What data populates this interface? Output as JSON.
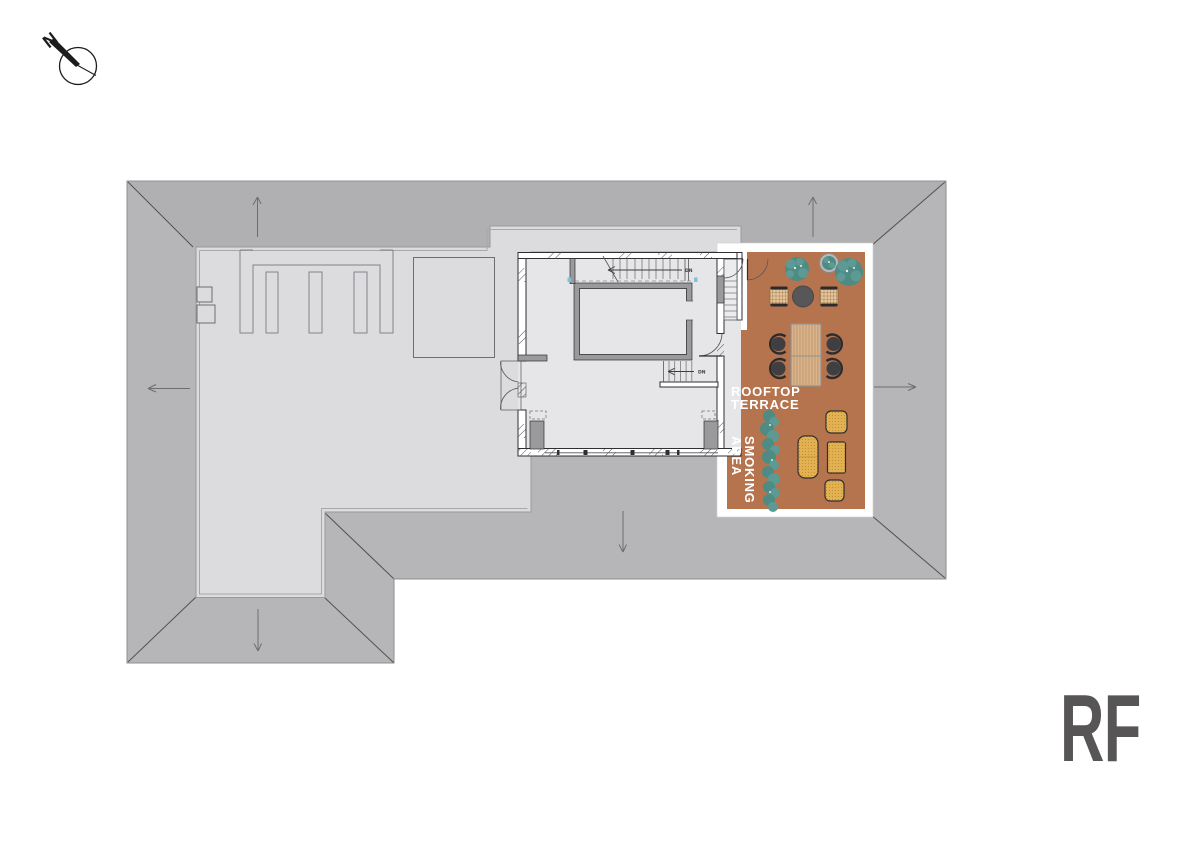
{
  "document": {
    "type": "architectural rooftop floor plan",
    "background": "#ffffff"
  },
  "labels": {
    "floor_code": "RF",
    "terrace_line1": "ROOFTOP",
    "terrace_line2": "TERRACE",
    "smoking_line1": "SMOKING",
    "smoking_line2": "AREA",
    "north": "N",
    "dn_upper": "DN",
    "dn_lower": "DN"
  },
  "areas": [
    "ROOFTOP TERRACE",
    "SMOKING AREA"
  ],
  "symbols": [
    "north-arrow-icon",
    "roof-slope-arrow",
    "stair-run",
    "door-swing",
    "roof-hatch-skylight",
    "rooftop-equipment-louvers",
    "roof-vent-boxes"
  ],
  "terrace_furniture": [
    "shrub-planter",
    "potted-plant",
    "shrub-planter",
    "round-bistro-table",
    "rattan-armchair",
    "rattan-armchair",
    "wood-dining-table",
    "dining-chair",
    "dining-chair",
    "dining-chair",
    "dining-chair",
    "hedge-screen",
    "outdoor-sofa",
    "lounge-chair",
    "outdoor-coffee-table",
    "lounge-chair"
  ],
  "colors": {
    "roof-slope": "#b6b6b8",
    "roof-top-plane": "#b0b0b2",
    "roof-flat": "#dcdcde",
    "building": "#e6e6e8",
    "wall-line": "#2f2f31",
    "outline": "#8f8f91",
    "terrace": "#b5744d",
    "terrace-frame": "#ffffff",
    "plant": "#4e8b85",
    "plant-light": "#5d9a93",
    "wood": "#d9b38c",
    "wood-line": "#b28a5f",
    "chair-dark": "#3f3f41",
    "rattan": "#e4c79e",
    "lounge": "#e3b052",
    "lounge-dot": "#a97f1f",
    "label": "#ffffff",
    "floor-code": "#575556",
    "compass": "#1c1c1c",
    "arrow": "#6e6e70",
    "accent-tick": "#7cc4d4"
  }
}
